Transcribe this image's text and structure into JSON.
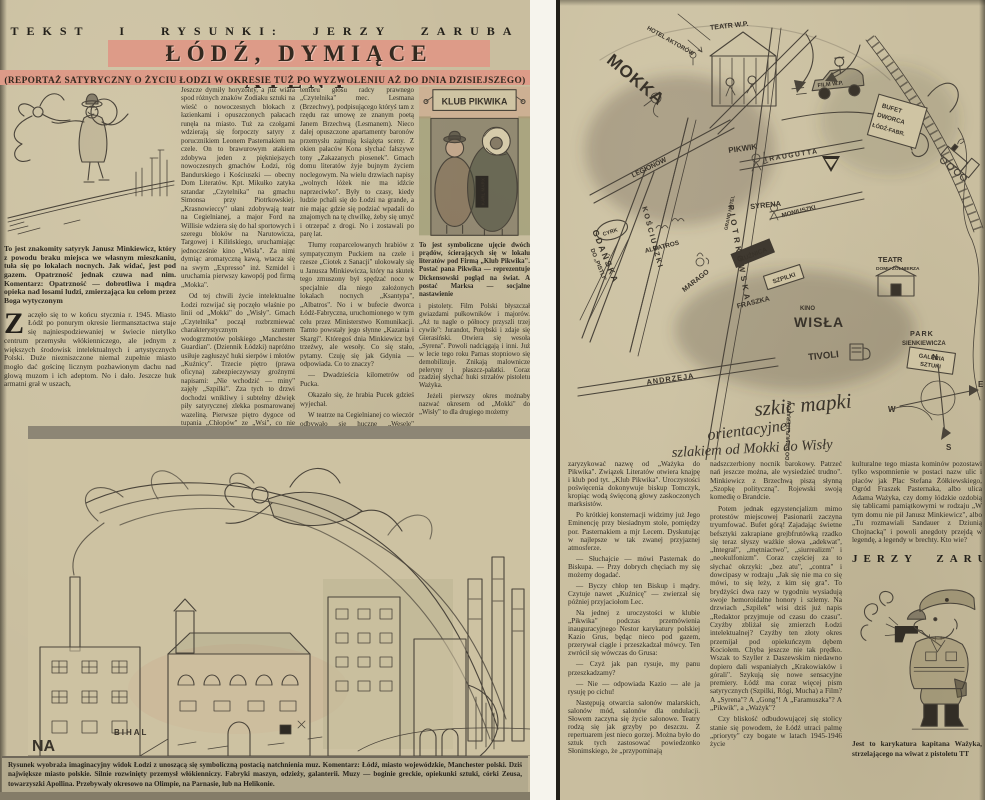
{
  "colors": {
    "paper": "#c9be9f",
    "banner": "#dd9b88",
    "ink": "#2e2a22",
    "sketch": "#4a443a"
  },
  "left": {
    "byline": "TEKST I RYSUNKI: JERZY ZARUBA",
    "title": "ŁÓDŹ, DYMIĄCE ATENY",
    "subtitle": "(REPORTAŻ SATYRYCZNY O ŻYCIU ŁODZI W OKRESIE TUŻ PO WYZWOLENIU AŻ DO DNIA DZISIEJSZEGO)",
    "tightrope_caption": "To jest znakomity satyryk Janusz Minkiewicz, który z powodu braku miejsca we własnym mieszkaniu, tuła się po lokalach nocnych. Jak widać, jest pod gazem. Opatrzność jednak czuwa nad nim. Komentarz: Opatrzność — dobrotliwa i mądra opieka nad losami ludzi, zmierzająca ku celom przez Boga wytyczonym",
    "dropcap": "Z",
    "opening_para": "aczęło się to w końcu stycznia r. 1945. Miasto Łódź po ponurym okresie liermansztactwa staje się najniespodziewaniej w świecie nietylko centrum przemysłu włókienniczego, ale jednym z większych środowisk intelektualnych i artystycznych Polski. Duże niezniszczone niemal zupełnie miasto mogło dać gościnę licznym pozbawionym dachu nad głową muzom i ich adeptom. No i dało. Jeszcze huk armatni grał w uszach,",
    "col2_paras": [
      "Jeszcze dymiły horyzonty, a już wiara spod różnych znaków Zodiaku sztuki na wieść o nowoczesnych blokach z łazienkami i opuszczonych pałacach runęła na miasto. Tuż za czołgami wdzierają się forpoczty satyry z porucznikiem Leonem Pasternakiem na czele. On to brawurowym atakiem zdobywa jeden z piękniejszych nowoczesnych gmachów Łodzi, róg Bandurskiego i Kościuszki — obecny Dom Literatów. Kpt. Mikułko zatyka sztandar „Czytelnika\" na gmachu Simonsa przy Piotrkowskiej. „Krasnowieccy\" ułani zdobywają teatr na Cegielnianej, a major Ford na Willisie wdziera się do hal sportowych i szeregu bloków na Narutowicza, Targowej i Kilińskiego, uruchamiając jednocześnie kino „Wisła\". Za nimi dymiąc aromatyczną kawą, wtacza się na swym „Expresso\" inż. Szmidel i uruchamia pierwszy kawopój pod firmą „Mokka\".",
      "Od tej chwili życie intelektualne Łodzi rozwijać się poczęło właśnie po linii od „Mokki\" do „Wisły\". Gmach „Czytelnika\" począł rozbrzmiewać charakterystycznym szumem wodogrzmotów polskiego „Manchester Guardian\". (Dziennik Łódzki) napróżno usiłuje zagłuszyć huki sierpów i młotów „Kuźnicy\". Trzecie piętro (prawa oficyna) zabezpieczywszy groźnymi napisami: „Nie wchodzić — miny\" zajęły „Szpilki\". Zza tych to drzwi dochodzi wnikliwy i subtelny dźwięk piły satyrycznej zlekka posmarowanej wazeliną. Pierwsze piętro dygoce od tupania „Chłopów\" ze „Wsi\", co nie przeszkadza jednak słyszeć uwodzicielskiego"
    ],
    "col3_paras": [
      "tembru głosu radcy prawnego „Czytelnika\" mec. Lesmana (Brzechwy), podpisującego któryś tam z rzędu raz umowę ze znanym poetą Janem Brzechwą (Lesmanem). Nieco dalej opuszczone apartamenty baronów przemysłu zajmują książęta sceny. Z okien pałaców Kona słychać fałszywe tony „Zakazanych piosenek\". Gmach domu literatów żyje bujnym życiem noclegowym. Na wielu drzwiach napisy „wolnych łóżek nie ma idźcie naprzeciwko\". Były to czasy, kiedy ludzie pchali się do Łodzi na grande, a nie mając gdzie się podziać wpadali do znajomych na tę chwilkę, żeby się umyć i otrzepać z drogi. No i zostawali po parę lat.",
      "Tłumy rozparcelowanych hrabiów z sympatycznym Puckiem na czele i rzesze „Ciotek z Sanacji\" ulokowały się u Janusza Minkiewicza, który na skutek tego zmuszony był spędzać noce w specjalnie dla niego założonych lokalach nocnych „Ksantypa\", „Albatros\". No i w bufecie dworca Łódź-Fabryczna, uruchomionego w tym celu przez Ministerstwo Komunikacji. Tamto powstały jego słynne „Kazania i Skargi\". Któregoś dnia Minkiewicz był trzeźwy, ale wesoły. Co się stało, pytamy. Czuję się jak Gdynia — odpowiada. Co to znaczy?",
      "— Dwadzieścia kilometrów od Pucka.",
      "Okazało się, że hrabia Pucek gdzieś wyjechał.",
      "W teatrze na Cegielnianej co wieczór odbywało się huczne „Wesele\" Wyspiańskiego i „wszystkim się zdawało, że to gra teatr, a to wojsko grało\". Łódź artystyczna nosiła jeszcze wtedy mundury"
    ],
    "klub_sign": "KLUB PIKWIKA",
    "karl_marx": "KARL MARX",
    "pikwik_caption": "To jest symboliczne ujęcie dwóch prądów, ścierających się w lokalu literatów pod Firmą „Klub Pikwika\". Postać pana Pikwika — reprezentuje Dickensowski pogląd na świat. A postać Marksa — socjalne nastawienie",
    "col4_paras": [
      "i pistolety. Film Polski błyszczał gwiazdami pułkowników i majorów. „Aż tu nagle o północy przyszli trzej cywile\": Jurandot, Porębski i zdaje się Gierasiński. Otwiera się wesoła „Syrena\". Powoli nadciągają i inni. Już w lecie tego roku Parnas stopniowo się demobilizuje. Znikają malownicze peleryny i płaszcz-pałatki. Coraz rzadziej słychać huki strzałów pistoletu Ważyka.",
      "Jeżeli pierwszy okres możnaby nazwać okresem od „Mokki\" do „Wisły\" to dla drugiego możemy"
    ],
    "city_labels": {
      "na": "NA",
      "bihal": "BIHAL"
    },
    "main_caption": "Rysunek wyobraża imaginacyjny widok Łodzi z unoszącą się symboliczną postacią natchnienia muz. Komentarz: Łódź, miasto wojewódzkie, Manchester polski. Dziś największe miasto polskie. Silnie rozwinięty przemysł włókienniczy. Fabryki maszyn, odzieży, galanterii. Muzy — boginie greckie, opiekunki sztuki, córki Zeusa, towarzyszki Apollina. Przebywały okresowo na Olimpie, na Parnasie, lub na Helikonie."
  },
  "right": {
    "map": {
      "labels": {
        "mokka": "MOKKA",
        "hotel_aktorow": "HOTEL AKTORÓW",
        "teatr_wp": "TEATR W.P.",
        "film_wp": "FILM W.P.",
        "traugutta": "TRAUGUTTA",
        "legionow": "LEGIONÓW",
        "pikwik": "PIKWIK",
        "grand_hotel": "GRAND HOTEL",
        "syrena": "SYRENA",
        "moniuszki": "MONIUSZKI",
        "piotrkowska": "PIOTRKOWSKA",
        "kosciuszki": "KOŚCIUSZKI",
        "gdanska": "GDAŃSKA",
        "andrzeja": "ANDRZEJA",
        "albatros": "ALBATROS",
        "marago": "MARAGO",
        "cyrk": "CYRK",
        "do_pistli": "DO „PISTLI\"",
        "kuznica": "KUŹNICA",
        "szpilki": "SZPILKI",
        "fraszka": "FRASZKA",
        "kino": "KINO",
        "wisla": "WISŁA",
        "tivoli": "TIVOLI",
        "do_domu_literatow": "DO DOMU LITERATÓW"
      },
      "bufet_lines": [
        "BUFET",
        "DWORCA",
        "ŁÓDŹ-FABR."
      ],
      "teatr_domu_lines": [
        "TEATR",
        "DOMU ŻOŁNIERZA"
      ],
      "park_lines": [
        "PARK",
        "SIENKIEWICZA"
      ],
      "galeria_lines": [
        "GALERIA",
        "SZTUKI"
      ],
      "compass": {
        "n": "N",
        "e": "E",
        "s": "S",
        "w": "W"
      },
      "handwriting": [
        "szkic mapki",
        "orientacyjnej",
        "szlakiem od Mokki do Wisły"
      ]
    },
    "col1_paras": [
      "zaryzykować nazwę od „Ważyka do Pikwika\". Związek Literatów otwiera knajpę i klub pod tyt. „Klub Pikwika\". Uroczystości poświęcenia dokonywuje biskup Tomczyk, kropiąc wodą święconą głowy zaskoczonych marksistów.",
      "Po krótkiej konsternacji widzimy już Jego Eminencję przy biesiadnym stole, pomiędzy por. Pasternakiem a mjr Lecem. Dyskutując w najlepsze w tak zwanej przyjaznej atmosferze.",
      "— Słuchajcie — mówi Pasternak do Biskupa. — Przy dobrych chęciach my się możemy dogadać.",
      "— Byczy chłop ten Biskup i mądry. Czytuje nawet „Kuźnicę\" — zwierzał się później przyjaciołom Lec.",
      "Na jednej z uroczystości w klubie „Pikwika\" podczas przemówienia inauguracyjnego Nestor karykatury polskiej Kazio Grus, będąc nieco pod gazem, przerywał ciągle i przeszkadzał mówcy. Ten zwrócił się wówczas do Grusa:",
      "— Czyż jak pan rysuje, my panu przeszkadzamy?",
      "— Nie — odpowiada Kazio — ale ja rysuję po cichu!",
      "Następują otwarcia salonów malarskich, salonów mód, salonów dla ondulacji. Słowem zaczyna się życie salonowe. Teatry rodzą się jak grzyby po deszczu. Z repertuarem jest nieco gorzej. Można było do sztuk tych zastosować powiedzonko Słonimskiego, że „przypominają"
    ],
    "col2_paras": [
      "nadszczerbiony nocnik barokowy. Patrzeć nań jeszcze można, ale wysiedzieć trudno\". Minkiewicz z Brzechwą piszą słynną „Szopkę polityczną\". Rojewski swoją komedię o Brandcie.",
      "Potem jednak egzystencjalizm mimo protestów miejscowej Pasionarii zaczyna tryumfować. Bufet górą! Zajadając świetne befsztyki zakrapiane grejbfrutówką rzadko się teraz słyszy ważkie słowa „adekwat\", „Integral\", „mętniactwo\", „siurrealizm\" i „neokulfonizm\". Coraz częściej za to słychać okrzyki: „bez atu\", „contra\" i dowcipasy w rodzaju „Jak się nie ma co się mówi, to się leży, z kim się gra\". To brydżyści dwa razy w tygodniu wysiadują swoje hemoroidalne honory i szlemy. Na drzwiach „Szpilek\" wisi dziś już napis „Redaktor przyjmuje od czasu do czasu\". Czyżby zbliżał się zmierzch Łodzi intelektualnej? Czyżby ten złoty okres przemijał pod opiekuńczym dębem Kociołem. Chyba jeszcze nie tak prędko. Wszak to Szyller z Daszewskim niedawno dopiero dali wspaniałych „Krakowiaków i górali\". Szykują się nowe sensacyjne premiery. Łódź ma coraz więcej pism satyrycznych (Szpilki, Rógi, Mucha) a Film? A „Syrena\"? A „Gong\"! A „Faramuszka\"? A „Pikwik\", a „Ważyk\"?",
      "Czy bliskość odbudowującej się stolicy stanie się powodem, że Łódź utraci palmę „prioryty\" czy bogate w latach 1945-1946 życie"
    ],
    "col3_paras": [
      "kulturalne tego miasta kominów pozostawi tylko wspomnienie w postaci nazw ulic i placów jak Plac Stefana Żółkiewskiego, Ogród Fraszek Pasternaka, albo ulica Adama Ważyka, czy domy łódzkie ozdobią się tablicami pamiątkowymi w rodzaju „W tym domu nie pił Janusz Minkiewicz\", albo „Tu rozmawiali Sandauer z Dziunią Chojnacką\" i powoli anegdoty przejdą w legendę, a legendy w brechty. Kto wie?"
    ],
    "signature": "JERZY ZARUBA",
    "wazyk_caption": "Jest to karykatura kapitana Ważyka, strzelającego na wiwat z pistoletu TT"
  }
}
